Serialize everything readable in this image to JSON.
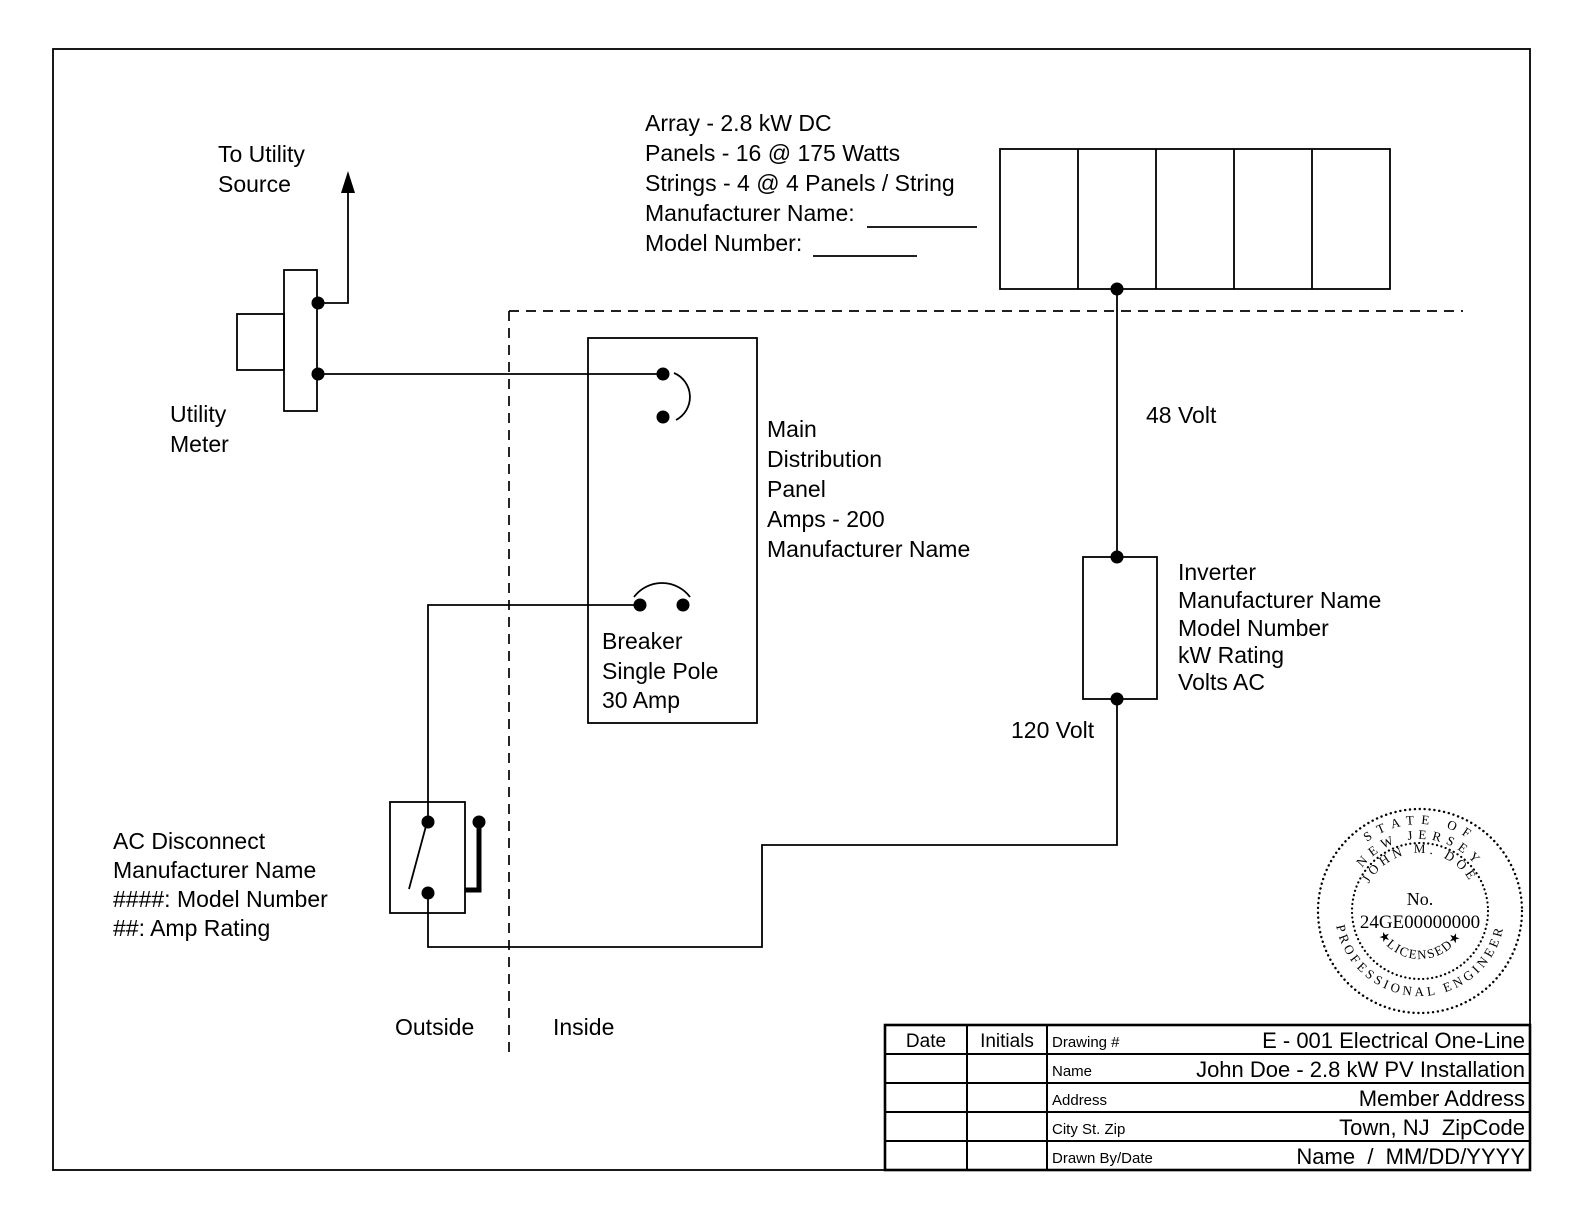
{
  "sheet": {
    "to_utility_source": [
      "To Utility",
      "Source"
    ],
    "utility_meter": [
      "Utility",
      "Meter"
    ],
    "array_notes": [
      "Array - 2.8 kW DC",
      "Panels - 16 @ 175 Watts",
      "Strings - 4 @ 4 Panels / String",
      "Manufacturer Name:",
      "Model Number:"
    ],
    "dc_voltage_label": "48 Volt",
    "ac_voltage_label": "120 Volt",
    "inverter_notes": [
      "Inverter",
      "Manufacturer Name",
      "Model Number",
      "kW Rating",
      "Volts AC"
    ],
    "main_panel_notes": [
      "Main",
      "Distribution",
      "Panel",
      "Amps - 200",
      "Manufacturer Name"
    ],
    "breaker_notes": [
      "Breaker",
      "Single Pole",
      "30 Amp"
    ],
    "ac_disconnect_notes": [
      "AC Disconnect",
      "Manufacturer Name",
      "####: Model Number",
      "##: Amp Rating"
    ],
    "outside_label": "Outside",
    "inside_label": "Inside"
  },
  "stamp": {
    "state_of": "STATE OF",
    "new_jersey": "NEW JERSEY",
    "engineer_name": "JOHN M. DOE",
    "no_label": "No.",
    "license_number": "24GE00000000",
    "licensed": "★LICENSED★",
    "professional_engineer": "PROFESSIONAL ENGINEER"
  },
  "title_block": {
    "date_header": "Date",
    "initials_header": "Initials",
    "rows": [
      {
        "label": "Drawing #",
        "value": "E - 001 Electrical One-Line"
      },
      {
        "label": "Name",
        "value": "John Doe - 2.8 kW PV Installation"
      },
      {
        "label": "Address",
        "value": "Member Address"
      },
      {
        "label": "City St. Zip",
        "value": "Town, NJ  ZipCode"
      },
      {
        "label": "Drawn By/Date",
        "value": "Name  /  MM/DD/YYYY"
      }
    ]
  },
  "colors": {
    "ink": "#000000",
    "paper": "#ffffff"
  }
}
